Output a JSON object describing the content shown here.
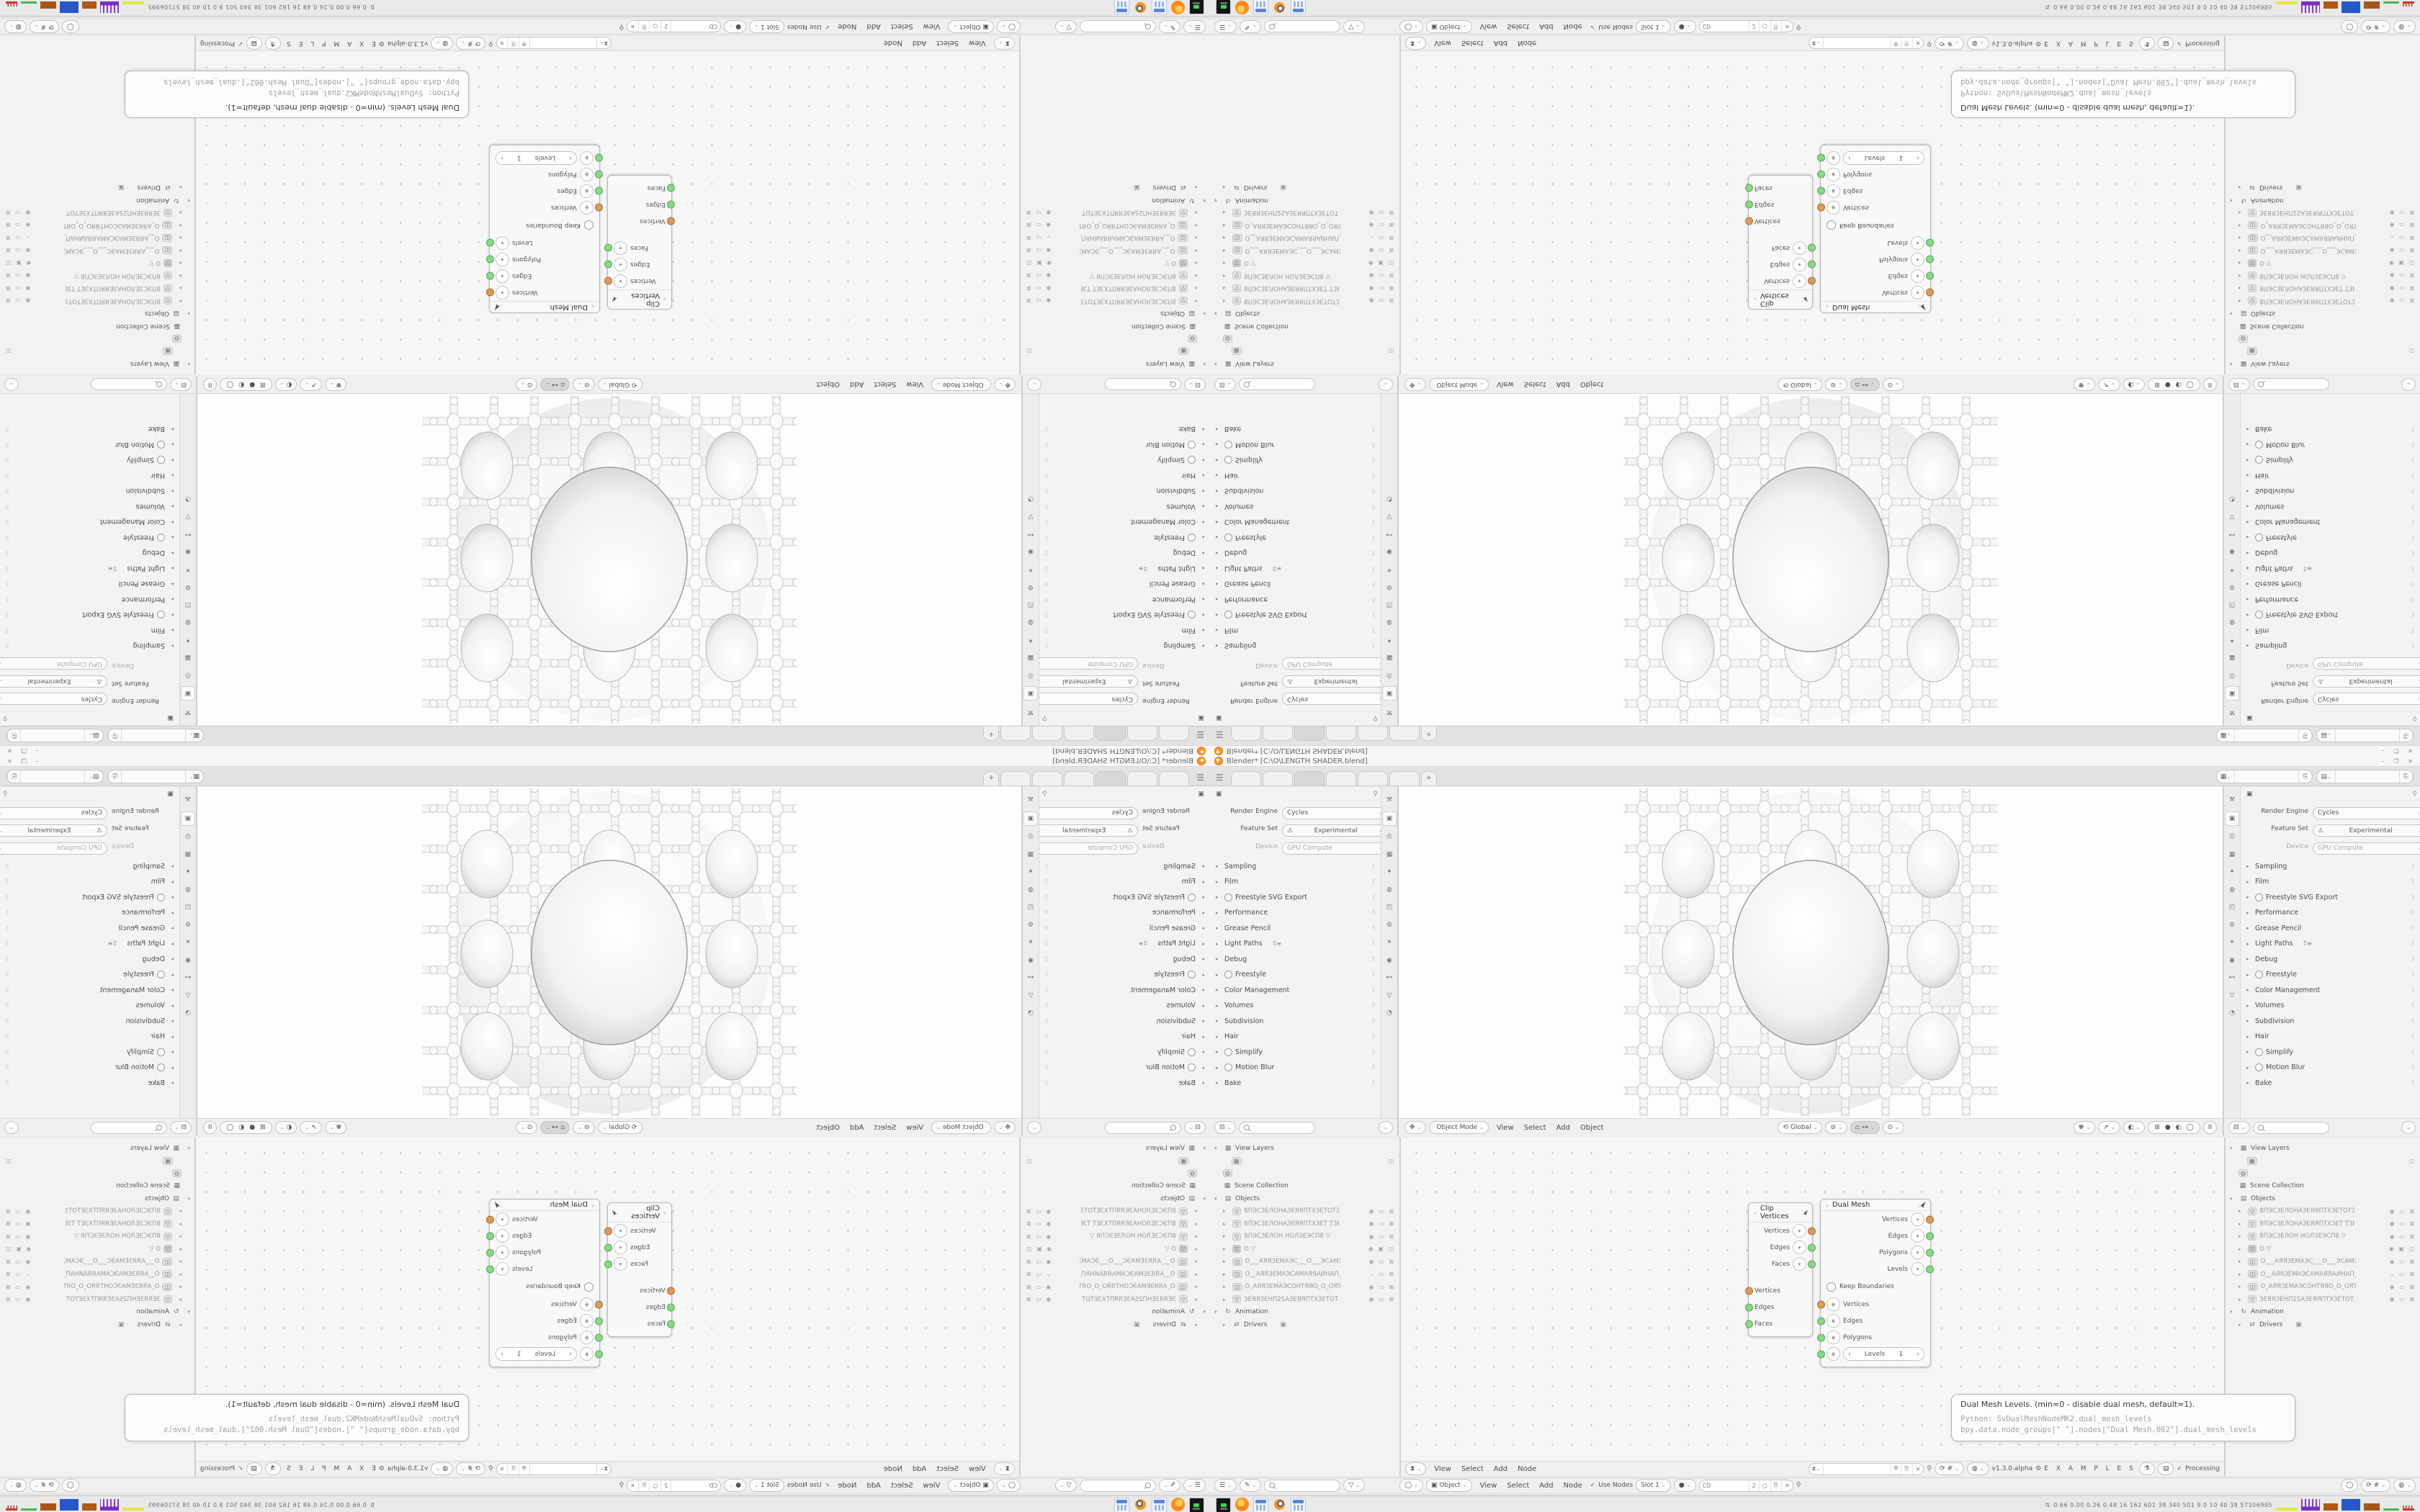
{
  "window": {
    "title": "Blender* [C:\\O\\LENGTH SHADER.blend]",
    "minimize": "–",
    "maximize": "❐",
    "close": "✕"
  },
  "workspace": {
    "menu_icon": "☰",
    "tabs": [
      {
        "state": ""
      },
      {
        "state": ""
      },
      {
        "state": "active"
      },
      {
        "state": ""
      },
      {
        "state": ""
      },
      {
        "state": ""
      }
    ],
    "new_tab": "+",
    "scene_icon": "▦",
    "view_layer_icon": "▤",
    "copy_icon": "⎘",
    "scene_value": "",
    "view_layer_value": ""
  },
  "render": {
    "context_icon": "▣",
    "pin_icon": "⚲",
    "engine_label": "Render Engine",
    "engine_value": "Cycles",
    "feature_label": "Feature Set",
    "feature_warning": "⚠",
    "feature_value": "Experimental",
    "device_label": "Device",
    "device_value": "GPU Compute",
    "panels": [
      {
        "label": "Sampling"
      },
      {
        "label": "Film"
      },
      {
        "label": "Freestyle SVG Export",
        "toggle": true
      },
      {
        "label": "Performance"
      },
      {
        "label": "Grease Pencil"
      },
      {
        "label": "Light Paths",
        "extra": "⠿≡"
      },
      {
        "label": "Debug"
      },
      {
        "label": "Freestyle",
        "toggle": true
      },
      {
        "label": "Color Management"
      },
      {
        "label": "Volumes"
      },
      {
        "label": "Subdivision"
      },
      {
        "label": "Hair"
      },
      {
        "label": "Simplify",
        "toggle": true
      },
      {
        "label": "Motion Blur",
        "toggle": true
      },
      {
        "label": "Bake"
      }
    ],
    "tabs": [
      {
        "name": "tool-tab",
        "glyph": "⚒",
        "state": ""
      },
      {
        "name": "render-tab",
        "glyph": "▣",
        "state": "active"
      },
      {
        "name": "output-tab",
        "glyph": "⎙",
        "state": ""
      },
      {
        "name": "view-layer-tab",
        "glyph": "▦",
        "state": ""
      },
      {
        "name": "scene-tab",
        "glyph": "✦",
        "state": ""
      },
      {
        "name": "world-tab",
        "glyph": "◍",
        "state": ""
      },
      {
        "name": "object-tab",
        "glyph": "◰",
        "state": ""
      },
      {
        "name": "modifiers-tab",
        "glyph": "⚙",
        "state": ""
      },
      {
        "name": "particles-tab",
        "glyph": "✴",
        "state": ""
      },
      {
        "name": "physics-tab",
        "glyph": "◉",
        "state": ""
      },
      {
        "name": "constraints-tab",
        "glyph": "⊷",
        "state": ""
      },
      {
        "name": "data-tab",
        "glyph": "▽",
        "state": ""
      },
      {
        "name": "material-tab",
        "glyph": "◔",
        "state": ""
      }
    ],
    "footer_editor_icon": "⊟",
    "footer_chevron": "⌄"
  },
  "viewport": {
    "mode_icon": "✥",
    "mode": "Object Mode",
    "menus": [
      "View",
      "Select",
      "Add",
      "Object"
    ],
    "orientation_icon": "⟲",
    "orientation": "Global",
    "pivot_icon": "⊘",
    "snap_icon": "⩍",
    "snap_with_icon": "⊶",
    "proportional_icon": "⊙",
    "overlay_icon": "✾",
    "select_icon": "➚",
    "gizmo_icon": "◐",
    "shading_icons": [
      "⊞",
      "●",
      "◐",
      "◯"
    ],
    "pause_label": "II"
  },
  "outliner": {
    "filter_icon": "▽",
    "view_layers_label": "View Layers",
    "view_layer_chip_icon": "▦",
    "camera_flag_icon": "◫",
    "world_chip_icon": "◍",
    "scene_collection_icon": "▦",
    "scene_collection_label": "Scene Collection",
    "objects_icon": "▤",
    "objects_label": "Objects",
    "objects": [
      {
        "glyph": "▽",
        "sel": "",
        "name": "8ПЭСЗЕЛОНАЗЕЯЯПТХЗЕТОТЗЕ)",
        "flags": "◉ ▭ ⊠"
      },
      {
        "glyph": "▽",
        "sel": "",
        "name": "8ПЭСЗЕЛОНАЗЕЯЯПТХЗЕТ ТЗЕХ",
        "flags": "◉ ▭ ⊠"
      },
      {
        "glyph": "▽",
        "sel": "",
        "name": "8ПЭСЗЕЛОН НОЛЗЕЭСП8   ▽",
        "flags": "◉ ▭ ⊠"
      },
      {
        "glyph": "▽",
        "sel": "selected",
        "name": "O    ▽",
        "flags": "◉ ▣ ◫"
      },
      {
        "glyph": "◫",
        "sel": "",
        "name": "O___АЯЯЗЕМАЭС___O___ЭСАМЗ",
        "flags": "◉ ▭ ⊠"
      },
      {
        "glyph": "◫",
        "sel": "",
        "name": "O__АЯЯЗЕМАЭСАМАЯЯАИНАП_С",
        "flags": "⌄ ▭ ⊠"
      },
      {
        "glyph": "◫",
        "sel": "",
        "name": "O_АЯЯЗЕМАЭСОНТЯЯО_O_ОЯТН",
        "flags": "◉ ▭ ⊠"
      },
      {
        "glyph": "▽",
        "sel": "",
        "name": "ЗЕЯЯЗЕНП2SАЗЕЯЯПТХЗЕТОТЗЕ",
        "flags": "◉ ▭ ⊠"
      }
    ],
    "animation_icon": "↻",
    "animation_label": "Animation",
    "drivers_icon": "⇄",
    "drivers_label": "Drivers",
    "drivers_flag": "▣",
    "footer_mode_icon": "☰",
    "footer_brush_icon": "✎"
  },
  "sverchok": {
    "editor_icon": "⧗",
    "menus": [
      "View",
      "Select",
      "Add",
      "Node"
    ],
    "search_value": "",
    "shield_icon": "⛨",
    "copy_icon": "⎘",
    "close_icon": "✕",
    "pin_icon": "⚲",
    "browse_icon": "⟳",
    "parent_icon": "#",
    "globe_icon": "◍",
    "version": "v1.3.0-alpha",
    "gear_icon": "⚙",
    "tree_name": "E X A M P L E S",
    "btn1_icon": "⚗",
    "btn2_icon": "▤",
    "status_check": "✓",
    "status": "Processing"
  },
  "shader": {
    "view_icon": "◯",
    "object_icon": "▣",
    "object_label": "Object",
    "menus": [
      "View",
      "Select",
      "Add",
      "Node"
    ],
    "use_nodes_check": "✓",
    "use_nodes": "Use Nodes",
    "slot": "Slot 1",
    "sphere_icon": "●",
    "material_name": "CD",
    "users_count": "2",
    "new_icon": "○",
    "copy_icon": "⎘",
    "close_icon": "✕",
    "pin_icon": "⚲"
  },
  "nodes": {
    "clip": {
      "title": "Clip Vertices",
      "collapse_chevron": "⌄",
      "outputs": [
        {
          "label": "Vertices",
          "color": "orange"
        },
        {
          "label": "Edges",
          "color": "green"
        },
        {
          "label": "Faces",
          "color": "green"
        }
      ],
      "inputs": [
        {
          "label": "Vertices",
          "color": "orange"
        },
        {
          "label": "Edges",
          "color": "green"
        },
        {
          "label": "Faces",
          "color": "green"
        }
      ]
    },
    "dual": {
      "title": "Dual Mesh",
      "collapse_chevron": "⌄",
      "outputs": [
        {
          "label": "Vertices",
          "color": "orange"
        },
        {
          "label": "Edges",
          "color": "green"
        },
        {
          "label": "Polygons",
          "color": "green"
        },
        {
          "label": "Levels",
          "color": "green"
        }
      ],
      "keep_boundaries": "Keep Boundaries",
      "inputs": [
        {
          "label": "Vertices",
          "color": "orange"
        },
        {
          "label": "Edges",
          "color": "green"
        },
        {
          "label": "Polygons",
          "color": "green"
        }
      ],
      "levels_left": "‹",
      "levels_label": "Levels",
      "levels_value": "1",
      "levels_right": "›",
      "plug_icon": "⋕",
      "dropdown_icon": "▾"
    }
  },
  "tooltip": {
    "line1": "Dual Mesh Levels. (min=0 - disable dual mesh, default=1).",
    "line2": "Python: SvDualMeshNodeMK2.dual_mesh_levels",
    "line3": "bpy.data.node_groups[\" \"].nodes[\"Dual Mesh.002\"].dual_mesh_levels"
  },
  "taskbar": {
    "icons": [
      {
        "name": "terminal-icon",
        "kind": "terminal"
      },
      {
        "name": "firefox-icon",
        "kind": "firefox"
      },
      {
        "name": "calculator-icon",
        "kind": "calculator"
      },
      {
        "name": "blender-icon",
        "kind": "blender"
      },
      {
        "name": "calculator2-icon",
        "kind": "calculator"
      }
    ],
    "arrows": "⇅",
    "stats": "0.66 0.00 0.26 0.48   16   162   601   38   340   501   9.0   10   40   38   57106995"
  },
  "colors": {
    "socket_orange": "#dd9a57",
    "socket_green": "#86d986",
    "accent_blue": "#4a79d9",
    "blender_orange": "#ff9421"
  }
}
